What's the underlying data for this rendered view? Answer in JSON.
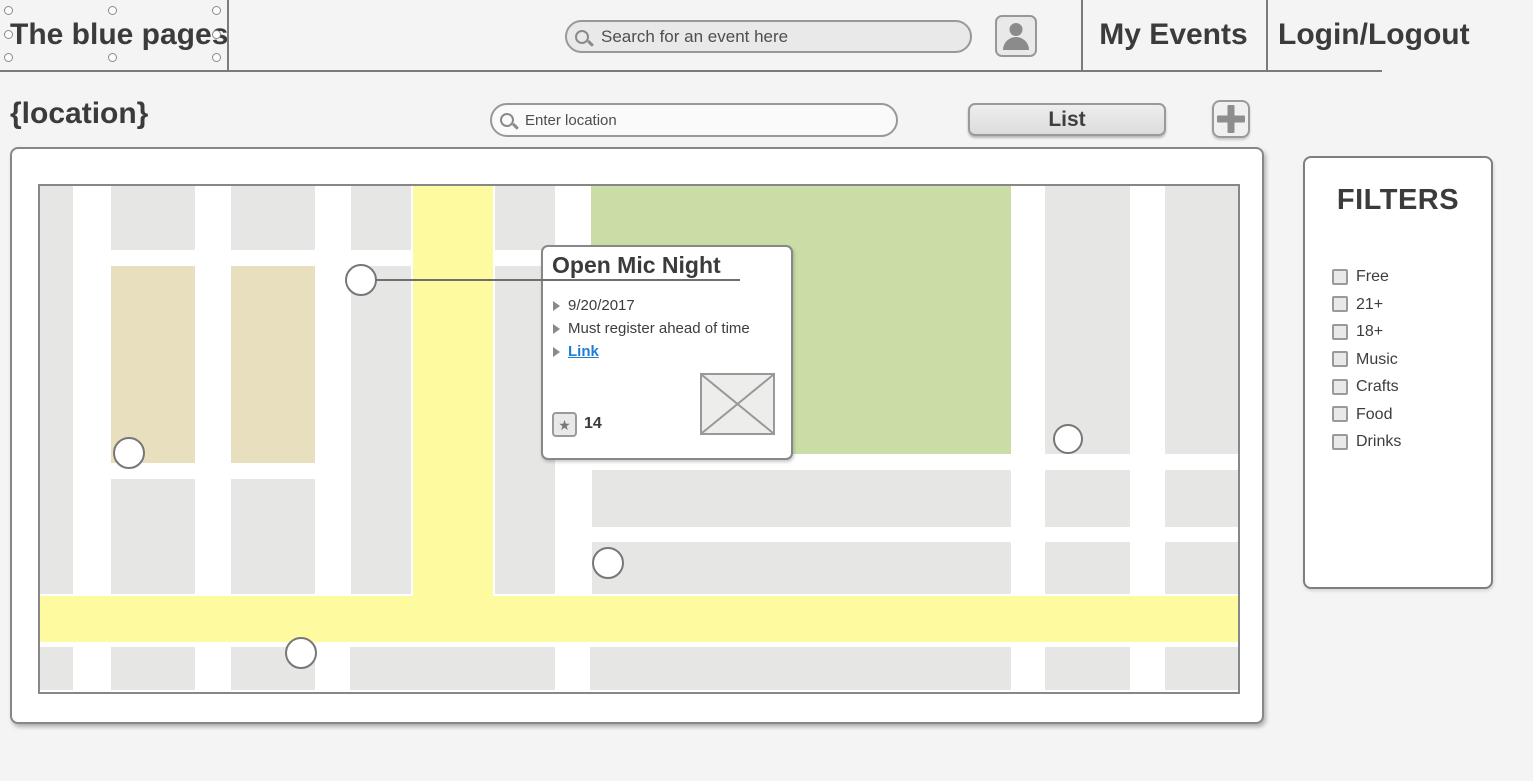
{
  "colors": {
    "link_blue": "#1f7ed6",
    "road_yellow": "#fdfa9f",
    "park_green": "#cbdda7",
    "block_tan": "#e7dfbe",
    "block_gray": "#e6e6e4"
  },
  "header": {
    "logo": "The blue pages",
    "search_placeholder": "Search for an event here",
    "nav_my_events": "My Events",
    "nav_login_logout": "Login/Logout"
  },
  "toolbar": {
    "location_label": "{location}",
    "location_placeholder": "Enter location",
    "list_button_label": "List",
    "add_button_label": "+"
  },
  "map": {
    "popup": {
      "title": "Open Mic Night",
      "details": [
        "9/20/2017",
        "Must register ahead of time"
      ],
      "link_label": "Link",
      "favorites_count": "14",
      "star_icon": "★"
    },
    "pins": [
      {
        "x": 321,
        "y": 94,
        "r": 16
      },
      {
        "x": 89,
        "y": 267,
        "r": 16
      },
      {
        "x": 1028,
        "y": 253,
        "r": 15
      },
      {
        "x": 568,
        "y": 377,
        "r": 16
      },
      {
        "x": 261,
        "y": 467,
        "r": 16
      }
    ]
  },
  "filters": {
    "title": "FILTERS",
    "options": [
      "Free",
      "21+",
      "18+",
      "Music",
      "Crafts",
      "Food",
      "Drinks"
    ]
  }
}
